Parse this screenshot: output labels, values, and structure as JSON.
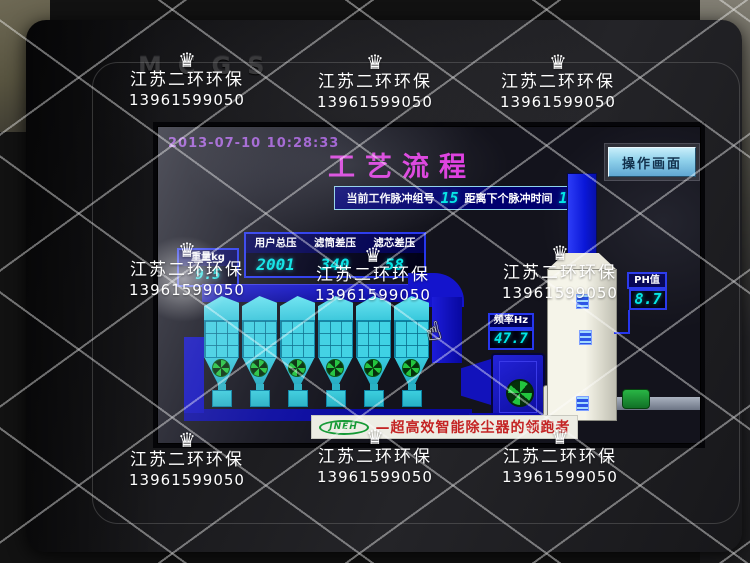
{
  "watermark": {
    "company": "江苏二环环保",
    "phone": "13961599050",
    "crown": "♛"
  },
  "device": {
    "brand": "MCGS"
  },
  "screen": {
    "timestamp": "2013-07-10 10:28:33",
    "title": "工艺流程",
    "operate_button": "操作画面",
    "pulse": {
      "group_label": "当前工作脉冲组号",
      "group_value": "15",
      "next_label": "距离下个脉冲时间",
      "next_value": "1"
    },
    "pressure": {
      "columns": [
        "用户总压",
        "滤筒差压",
        "滤芯差压"
      ],
      "values": [
        "2001",
        "340",
        "58"
      ]
    },
    "weight": {
      "label": "重量kg",
      "value": "9.5"
    },
    "ph": {
      "label": "PH值",
      "value": "8.7"
    },
    "frequency": {
      "label": "频率Hz",
      "value": "47.7"
    },
    "banner": {
      "logo_text": "JNEH",
      "slogan": "—超高效智能除尘器的领跑者"
    },
    "equipment": {
      "filter_module_count": 6
    }
  },
  "colors": {
    "accent_cyan": "#00e6e6",
    "panel_border_blue": "#2636ee",
    "title_magenta": "#e03ae0",
    "duct_blue": "#1212c8",
    "module_cyan": "#3ed2e4"
  }
}
